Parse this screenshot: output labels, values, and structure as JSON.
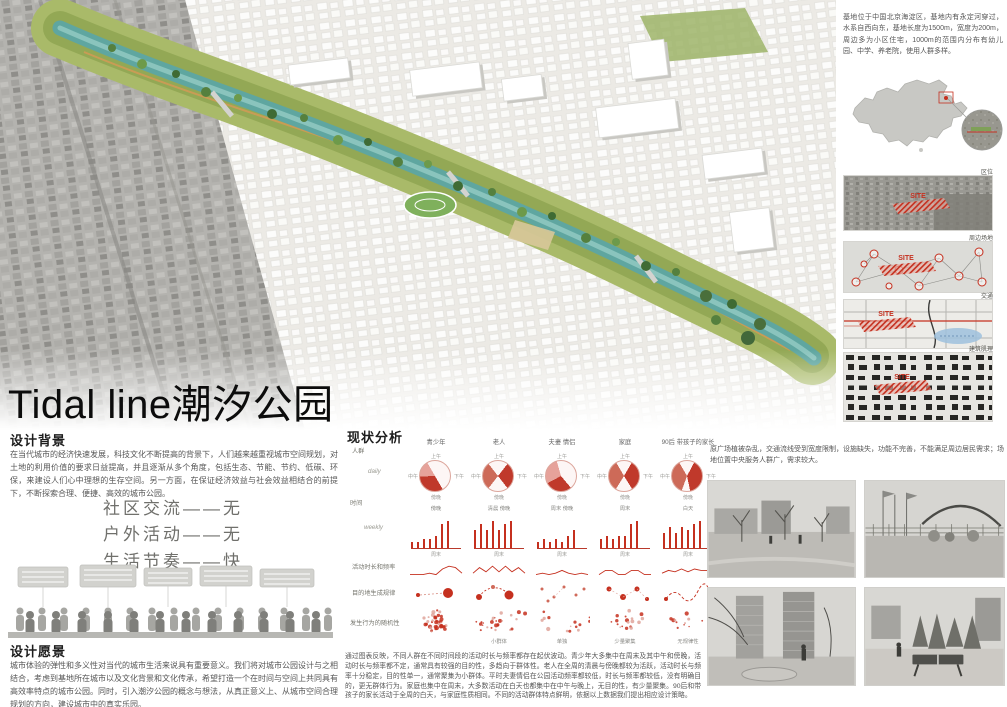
{
  "title": {
    "en": "Tidal line",
    "cn": "潮汐公园"
  },
  "intro_right": "基地位于中国北京海淀区，基地内有永定河穿过，水系自西向东，基地长度为1500m，宽度为200m，周边多为小区住宅，1000m的范围内分布有幼儿园、中学、养老院，使用人群多样。",
  "right_maps": {
    "site_label": "SITE",
    "labels": [
      "区位",
      "周边场地",
      "交通",
      "建筑肌理"
    ]
  },
  "design_background": {
    "heading": "设计背景",
    "body": "在当代城市的经济快速发展，科技文化不断提高的背景下，人们越来越重视城市空间规划，对土地的利用价值的要求日益提高，并且逐渐从多个角度，包括生态、节能、节约、低碳、环保，来建设人们心中理想的生存空间。另一方面，在保证经济效益与社会效益相结合的前提下，不断探索合理、便捷、高效的城市公园。"
  },
  "slogans": [
    "社区交流——无",
    "户外活动——无",
    "生活节奏——快"
  ],
  "design_vision": {
    "heading": "设计愿景",
    "body": "城市体验的弹性和多义性对当代的城市生活来说具有重要意义。我们将对城市公园设计与之相结合，考虑到基地所在城市以及文化背景和文化传承，希望打造一个在时间与空间上共同具有高效率特点的城市公园。同时，引入潮汐公园的概念与想法，从真正意义上、从城市空间合理规划的方向，建设城市中的真实乐园。"
  },
  "site_note": "原广场植被杂乱，交通流线受到宽度限制，设施缺失，功能不完善，不能满足周边居民需求；场地位置中央服务人群广，需求较大。",
  "status_analysis": {
    "heading": "现状分析",
    "row_labels": {
      "people": "人群",
      "daily": "daily",
      "time": "时间",
      "weekly": "weekly",
      "duration": "活动时长和频率",
      "destination": "目的地生成规律",
      "randomness": "发生行为的随机性"
    },
    "groups": [
      "青少年",
      "老人",
      "夫妻 情侣",
      "家庭",
      "90后 带孩子的家长"
    ],
    "summary": "通过图表反映，不同人群在不同时间段的活动时长与频率都存在起伏波动。青少年大多集中在周末及其中午和傍晚，活动时长与频率都不定，通常具有较强的目的性，多趋向于群体性。老人在全周的清晨与傍晚都较为活跃，活动时长与频率十分稳定，目的性单一，通常聚集为小群体。平时夫妻情侣在公园活动频率都较低，时长与频率都较低，没有明确目的，更无群体行为。家庭也集中在周末，大多数活动在白天也都集中在中午与晚上，无目的性，有少量聚集。90后和带孩子的家长活动于全周的白天，与家庭性质相同。不同的活动群体特点鲜明，依据以上数据我们提出相应设计策略。"
  },
  "chart_data": [
    {
      "type": "pie",
      "row": "daily 活动时间分布",
      "time_labels": [
        "上午",
        "下午",
        "傍晚",
        "中午"
      ],
      "peak_captions": [
        "傍晚",
        "清晨 傍晚",
        "周末 傍晚",
        "周末",
        "白天"
      ],
      "slices_deg": [
        [
          [
            150,
            268,
            "#c0392b"
          ],
          [
            268,
            330,
            "#e6a29a"
          ]
        ],
        [
          [
            38,
            142,
            "#c0392b"
          ],
          [
            218,
            322,
            "#cd6a58"
          ]
        ],
        [
          [
            140,
            242,
            "#c0392b"
          ],
          [
            242,
            344,
            "#e6a29a"
          ]
        ],
        [
          [
            30,
            148,
            "#c0392b"
          ],
          [
            212,
            330,
            "#cd6a58"
          ]
        ],
        [
          [
            28,
            168,
            "#c0392b"
          ],
          [
            200,
            330,
            "#cd6a58"
          ]
        ]
      ]
    },
    {
      "type": "bar",
      "row": "weekly 活动频率",
      "x": [
        "一",
        "二",
        "三",
        "四",
        "五",
        "六",
        "日"
      ],
      "ylim": [
        0,
        10
      ],
      "note": "周末",
      "series": [
        {
          "name": "青少年",
          "values": [
            2,
            2,
            3,
            3,
            4,
            8,
            9
          ]
        },
        {
          "name": "老人",
          "values": [
            6,
            8,
            6,
            9,
            6,
            8,
            9
          ]
        },
        {
          "name": "夫妻 情侣",
          "values": [
            2,
            3,
            2,
            3,
            2,
            4,
            6
          ]
        },
        {
          "name": "家庭",
          "values": [
            3,
            4,
            3,
            4,
            4,
            8,
            9
          ]
        },
        {
          "name": "90后 带孩子的家长",
          "values": [
            5,
            7,
            5,
            7,
            6,
            8,
            9
          ]
        }
      ]
    },
    {
      "type": "line",
      "row": "活动时长和频率",
      "ylim": [
        0,
        10
      ],
      "series": [
        {
          "name": "青少年",
          "values": [
            1,
            1,
            1,
            2,
            1,
            5,
            7,
            6,
            2
          ]
        },
        {
          "name": "老人",
          "values": [
            2,
            6,
            3,
            7,
            3,
            7,
            3,
            6,
            2
          ]
        },
        {
          "name": "夫妻 情侣",
          "values": [
            1,
            2,
            1,
            2,
            4,
            2,
            1,
            2,
            1
          ]
        },
        {
          "name": "家庭",
          "values": [
            1,
            4,
            4,
            1,
            1,
            4,
            4,
            1,
            1
          ]
        },
        {
          "name": "90后 带孩子的家长",
          "values": [
            2,
            4,
            3,
            5,
            3,
            5,
            4,
            4,
            3
          ]
        }
      ]
    },
    {
      "type": "scatter",
      "row": "目的地生成规律",
      "patterns": [
        "single-destination",
        "fixed-loop",
        "dispersed",
        "multi-spot",
        "wandering"
      ]
    },
    {
      "type": "scatter",
      "row": "发生行为的随机性",
      "captions": [
        "",
        "小群体",
        "单独",
        "少量聚集",
        "无规律性"
      ],
      "density": [
        {
          "n": 40,
          "spread": 16
        },
        {
          "n": 26,
          "spread": 30
        },
        {
          "n": 14,
          "spread": 34
        },
        {
          "n": 18,
          "spread": 30
        },
        {
          "n": 12,
          "spread": 30
        }
      ]
    }
  ],
  "colors": {
    "accent_red": "#c5301f",
    "river_teal": "#5fa6a0",
    "park_green": "#93a855"
  }
}
